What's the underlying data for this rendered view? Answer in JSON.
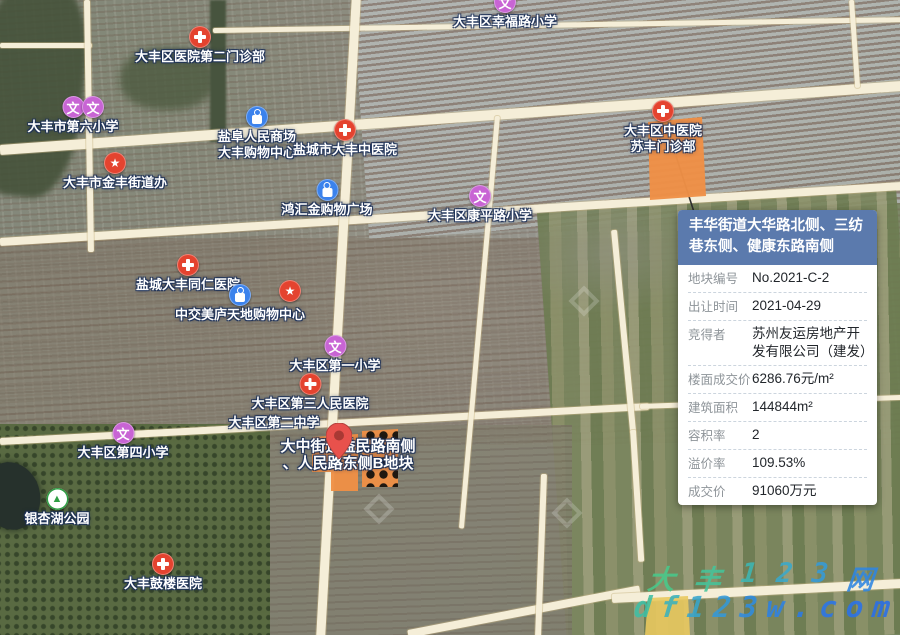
{
  "panel": {
    "title": "丰华街道大华路北侧、三纺巷东侧、健康东路南侧",
    "rows": [
      {
        "label": "地块编号",
        "value": "No.2021-C-2"
      },
      {
        "label": "出让时间",
        "value": "2021-04-29"
      },
      {
        "label": "竞得者",
        "value": "苏州友运房地产开发有限公司（建发）"
      },
      {
        "label": "楼面成交价",
        "value": "6286.76元/m²"
      },
      {
        "label": "建筑面积",
        "value": "144844m²"
      },
      {
        "label": "容积率",
        "value": "2"
      },
      {
        "label": "溢价率",
        "value": "109.53%"
      },
      {
        "label": "成交价",
        "value": "91060万元"
      }
    ]
  },
  "icon_glyphs": {
    "school": "文",
    "star": "★",
    "park": "▲"
  },
  "pois": [
    {
      "name": "school-xingfulu-primary",
      "type": "school",
      "x": 505,
      "y": 2,
      "lines": [
        "大丰区幸福路小学"
      ]
    },
    {
      "name": "hospital-district-no2-clinic",
      "type": "hospital",
      "x": 200,
      "y": 37,
      "lines": [
        "大丰区医院第二门诊部"
      ]
    },
    {
      "name": "school-no6-primary",
      "type": "school",
      "x": 73,
      "y": 107,
      "lines": [
        "大丰市第六小学"
      ]
    },
    {
      "name": "school-no6-primary-b",
      "type": "school",
      "x": 93,
      "y": 107,
      "lines": []
    },
    {
      "name": "mall-yanfu-renmin",
      "type": "shopping",
      "x": 257,
      "y": 117,
      "lines": [
        "盐阜人民商场",
        "大丰购物中心"
      ]
    },
    {
      "name": "hospital-dafeng-tcm",
      "type": "hospital",
      "x": 345,
      "y": 130,
      "lines": [
        "盐城市大丰中医院"
      ]
    },
    {
      "name": "gov-jinfeng-subdistrict",
      "type": "star",
      "x": 115,
      "y": 163,
      "lines": [
        "大丰市金丰街道办"
      ]
    },
    {
      "name": "mall-honghuijin",
      "type": "shopping",
      "x": 327,
      "y": 190,
      "lines": [
        "鸿汇金购物广场"
      ]
    },
    {
      "name": "school-kangpinglu-primary",
      "type": "school",
      "x": 480,
      "y": 196,
      "lines": [
        "大丰区康平路小学"
      ]
    },
    {
      "name": "hospital-tcm-sufeng-clinic",
      "type": "hospital",
      "x": 663,
      "y": 111,
      "lines": [
        "大丰区中医院",
        "苏丰门诊部"
      ]
    },
    {
      "name": "hospital-tongren",
      "type": "hospital",
      "x": 188,
      "y": 265,
      "lines": [
        "盐城大丰同仁医院"
      ]
    },
    {
      "name": "mall-zhongjiao-meilu",
      "type": "shopping",
      "x": 240,
      "y": 295,
      "lines": [
        "中交美庐天地购物中心"
      ]
    },
    {
      "name": "star-poi",
      "type": "star",
      "x": 290,
      "y": 291,
      "lines": []
    },
    {
      "name": "school-no1-primary",
      "type": "school",
      "x": 335,
      "y": 346,
      "lines": [
        "大丰区第一小学"
      ]
    },
    {
      "name": "hospital-no3-people",
      "type": "hospital",
      "x": 310,
      "y": 384,
      "lines": [
        "大丰区第三人民医院"
      ]
    },
    {
      "name": "school-no2-middle",
      "type": "label",
      "x": 274,
      "y": 423,
      "lines": [
        "大丰区第二中学"
      ]
    },
    {
      "name": "school-no4-primary",
      "type": "school",
      "x": 123,
      "y": 433,
      "lines": [
        "大丰区第四小学"
      ]
    },
    {
      "name": "park-yinxinghu",
      "type": "park",
      "x": 57,
      "y": 499,
      "lines": [
        "银杏湖公园"
      ]
    },
    {
      "name": "hospital-gulou",
      "type": "hospital",
      "x": 163,
      "y": 564,
      "lines": [
        "大丰鼓楼医院"
      ]
    },
    {
      "name": "parcel-b-label",
      "type": "label",
      "x": 348,
      "y": 447,
      "big": true,
      "lines": [
        "大中街道益民路南侧",
        "、人民路东侧B地块"
      ]
    }
  ],
  "watermark": {
    "line1": [
      {
        "ch": "大",
        "c": "#49c98b"
      },
      {
        "ch": "丰",
        "c": "#45c49a"
      },
      {
        "ch": "1",
        "c": "#3eb7b4"
      },
      {
        "ch": "2",
        "c": "#3aa9cb"
      },
      {
        "ch": "3",
        "c": "#359bd9"
      },
      {
        "ch": "网",
        "c": "#2f86e2"
      }
    ],
    "line2": [
      {
        "ch": "d",
        "c": "#3fbfa5"
      },
      {
        "ch": "f",
        "c": "#3bb2bd"
      },
      {
        "ch": "1",
        "c": "#37a6cd"
      },
      {
        "ch": "2",
        "c": "#3499d8"
      },
      {
        "ch": "3",
        "c": "#308ce0"
      },
      {
        "ch": "w",
        "c": "#2e82e5"
      },
      {
        "ch": ".",
        "c": "#2c7ae8"
      },
      {
        "ch": "c",
        "c": "#2b76e9"
      },
      {
        "ch": "o",
        "c": "#2a72ea"
      },
      {
        "ch": "m",
        "c": "#296fea"
      }
    ]
  },
  "colors": {
    "parcel_orange": "#ef9046",
    "parcel_dot": "#1c140c",
    "parcel_yellow": "#e9c95f",
    "panel_header": "#5b7aad",
    "hospital_red": "#e4432f",
    "school_purple": "#c864d4",
    "shopping_blue": "#3b82ec",
    "park_green": "#2f9e44"
  }
}
